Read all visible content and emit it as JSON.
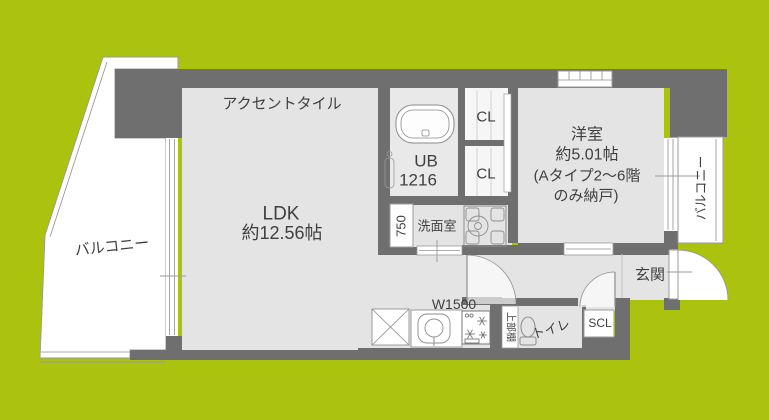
{
  "floor_plan": {
    "colors": {
      "background_green": "#abc30e",
      "wall_gray": "#6f6f6f",
      "floor_gray": "#e4e4e4",
      "fixture_white": "#ffffff"
    },
    "rooms": {
      "ldk": {
        "name": "LDK",
        "size": "約12.56帖",
        "feature": "アクセントタイル"
      },
      "western_room": {
        "name": "洋室",
        "size": "約5.01帖",
        "note_line1": "(Aタイプ2～6階",
        "note_line2": "のみ納戸)"
      },
      "unit_bath": {
        "name": "UB",
        "size": "1216"
      },
      "washroom": {
        "name": "洗面室",
        "vanity_width": "750"
      },
      "closet_upper": {
        "name": "CL"
      },
      "closet_lower": {
        "name": "CL"
      },
      "kitchen": {
        "width_label": "W1500",
        "shelf_label": "上部棚"
      },
      "toilet": {
        "name": "トイレ"
      },
      "shoe_closet": {
        "name": "SCL"
      },
      "entrance": {
        "name": "玄関"
      },
      "balcony_left": {
        "name": "バルコニー"
      },
      "balcony_right": {
        "name": "バルコニー"
      }
    }
  }
}
